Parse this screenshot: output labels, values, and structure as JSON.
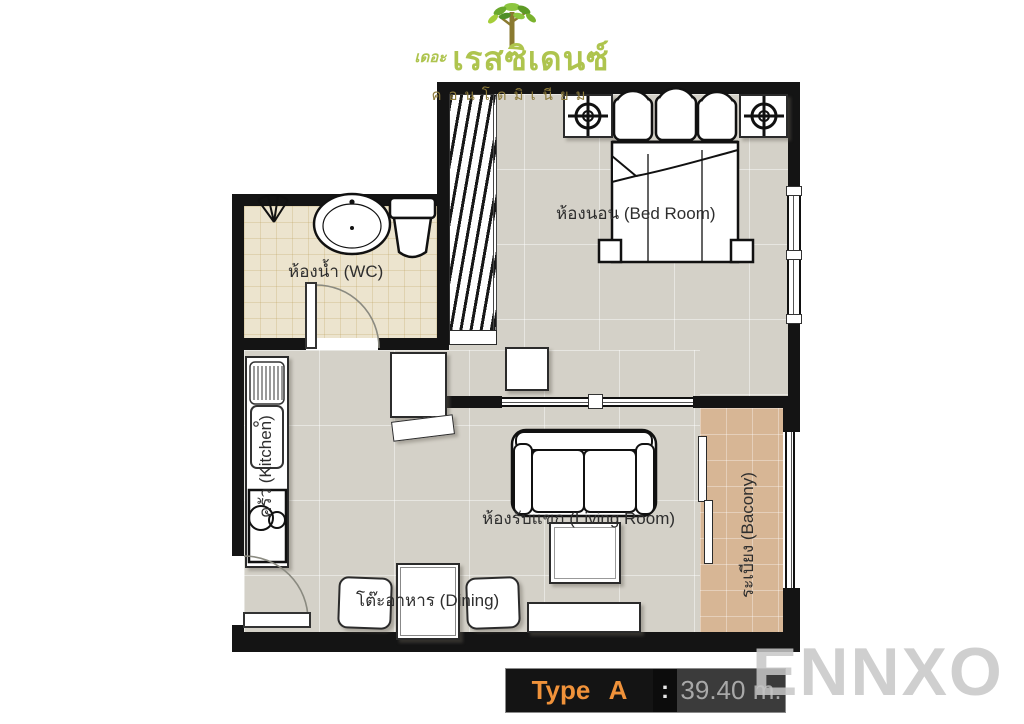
{
  "logo": {
    "prefix": "เดอะ",
    "name": "เรสซิเดนซ์",
    "subtitle": "คอนโดมิเนียม"
  },
  "rooms": {
    "bedroom": {
      "label": "ห้องนอน (Bed Room)"
    },
    "bathroom": {
      "label": "ห้องน้ำ (WC)"
    },
    "kitchen": {
      "label": "ครัว (Kitchen)"
    },
    "living": {
      "label": "ห้องรับแขก (Living Room)"
    },
    "dining": {
      "label": "โต๊ะอาหาร (Dining)"
    },
    "balcony": {
      "label": "ระเบียง (Bacony)"
    }
  },
  "footer": {
    "type_label": "Type A",
    "colon": ":",
    "area": "39.40 m."
  },
  "watermark": "ENNXO",
  "colors": {
    "wall": "#141414",
    "floor_main": "#d4d1c8",
    "floor_bath": "#ece4ce",
    "floor_balcony": "#d7b695",
    "accent_orange": "#f0923a",
    "area_text": "#a8a8a8",
    "logo_green": "#aec44e",
    "logo_olive": "#8d7b3b",
    "watermark_gray": "#c7c7c7"
  }
}
